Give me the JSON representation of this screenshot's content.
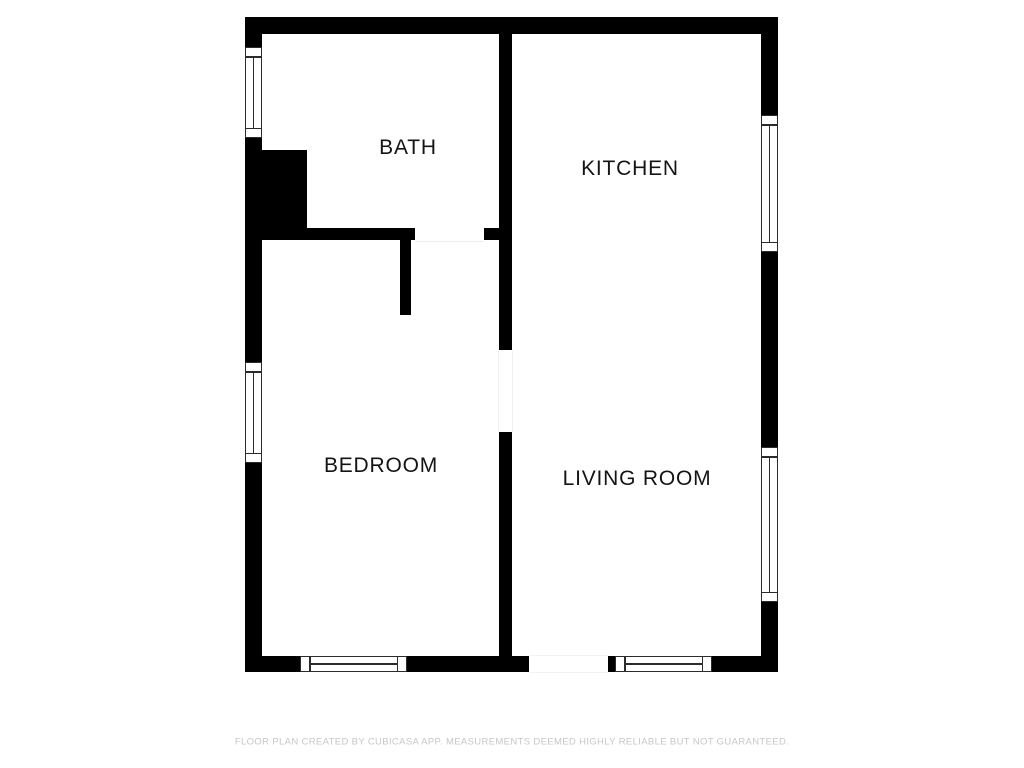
{
  "floorplan": {
    "rooms": [
      {
        "name": "bath",
        "label": "BATH"
      },
      {
        "name": "kitchen",
        "label": "KITCHEN"
      },
      {
        "name": "bedroom",
        "label": "BEDROOM"
      },
      {
        "name": "living_room",
        "label": "LIVING ROOM"
      }
    ],
    "disclaimer": "FLOOR PLAN CREATED BY CUBICASA APP. MEASUREMENTS DEEMED HIGHLY RELIABLE BUT NOT GUARANTEED.",
    "colors": {
      "wall": "#000000",
      "floor": "#ffffff",
      "label_text": "#141414",
      "window_frame": "#2b2b2b",
      "disclaimer_text": "#c7c7c7"
    }
  }
}
